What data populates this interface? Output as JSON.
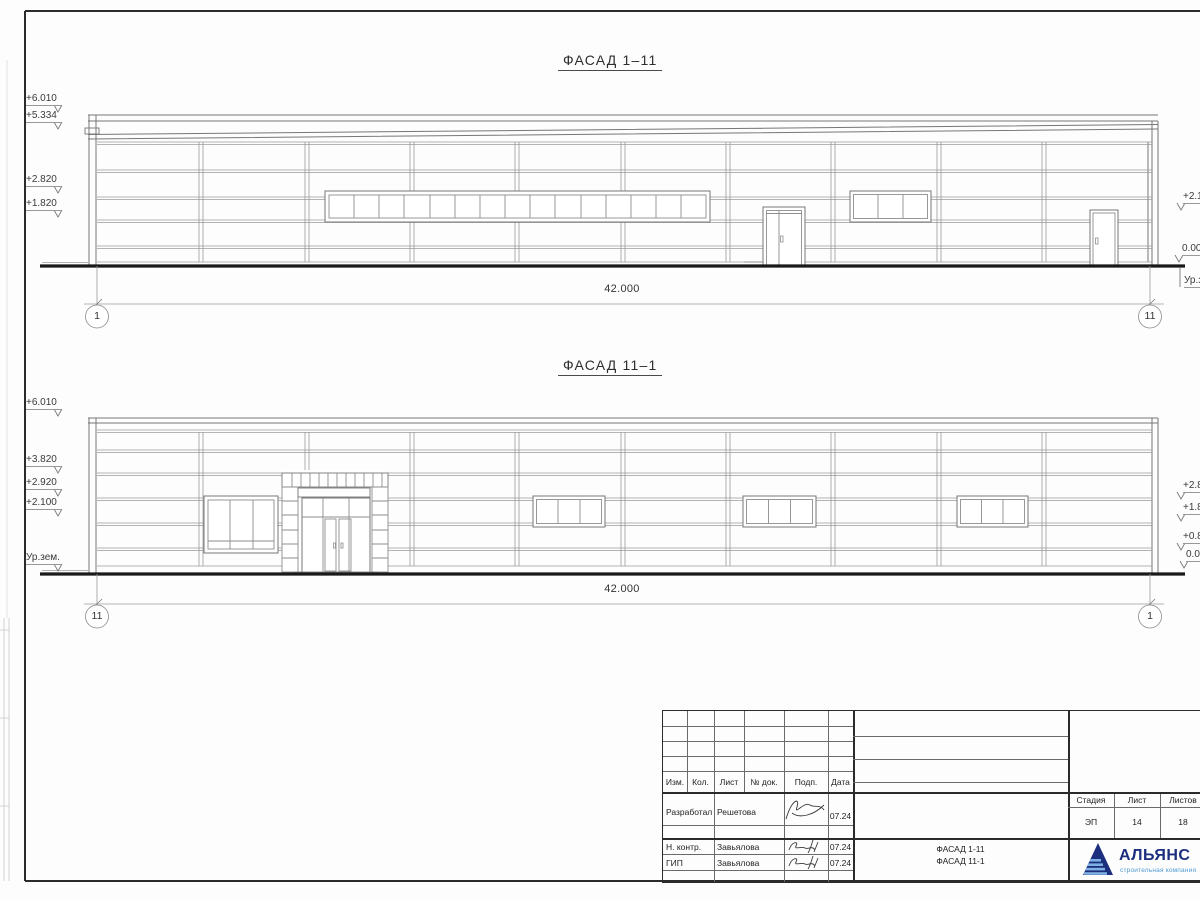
{
  "drawing": {
    "facade1": {
      "title": "ФАСАД 1–11",
      "dimension": "42.000",
      "axis_left": "1",
      "axis_right": "11",
      "marks_left": [
        "+6.010",
        "+5.334",
        "+2.820",
        "+1.820"
      ],
      "marks_right": [
        "+2.10",
        "0.00",
        "Ур.з"
      ]
    },
    "facade2": {
      "title": "ФАСАД 11–1",
      "dimension": "42.000",
      "axis_left": "11",
      "axis_right": "1",
      "marks_left": [
        "+6.010",
        "+3.820",
        "+2.920",
        "+2.100",
        "Ур.зем."
      ],
      "marks_right": [
        "+2.8",
        "+1.82",
        "+0.8",
        "0.0"
      ]
    },
    "stamp": {
      "rev_headers": [
        "Изм.",
        "Кол.",
        "Лист",
        "№ док.",
        "Подп.",
        "Дата"
      ],
      "rows": [
        {
          "role": "Разработал",
          "name": "Решетова",
          "date": "07.24"
        },
        {
          "role": "Н. контр.",
          "name": "Завьялова",
          "date": "07.24"
        },
        {
          "role": "ГИП",
          "name": "Завьялова",
          "date": "07.24"
        }
      ],
      "doc_title_line1": "ФАСАД 1-11",
      "doc_title_line2": "ФАСАД 11-1",
      "stage_label": "Стадия",
      "sheet_label": "Лист",
      "sheets_label": "Листов",
      "stage": "ЭП",
      "sheet": "14",
      "sheets": "18",
      "company": "АЛЬЯНС",
      "company_tagline": "строительная компания",
      "brand_dark": "#1c2e7e",
      "brand_light": "#7fb2e0"
    }
  }
}
